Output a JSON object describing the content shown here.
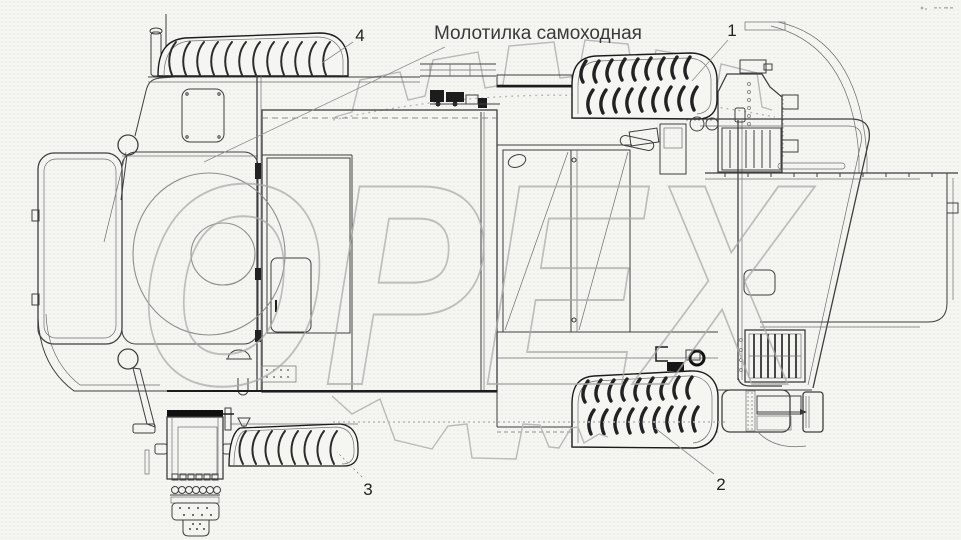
{
  "title": {
    "text": "Молотилка самоходная"
  },
  "watermark": {
    "text": "ОРЕХ"
  },
  "callouts": [
    {
      "label": "1",
      "target": "top-right-drive-tire"
    },
    {
      "label": "2",
      "target": "bottom-right-drive-tire"
    },
    {
      "label": "3",
      "target": "bottom-left-tire"
    },
    {
      "label": "4",
      "target": "top-left-tire"
    }
  ],
  "colors": {
    "background": "#f5f5f2",
    "line": "#3f3f3f",
    "dark_line": "#1c1c1c",
    "watermark": "#a9a9a9",
    "gear": "#b9b9b9",
    "leader": "#8f8f8f",
    "title_text": "#3a3a3a"
  },
  "drawing": {
    "subject": "combine-harvester-thresher-top-view"
  }
}
